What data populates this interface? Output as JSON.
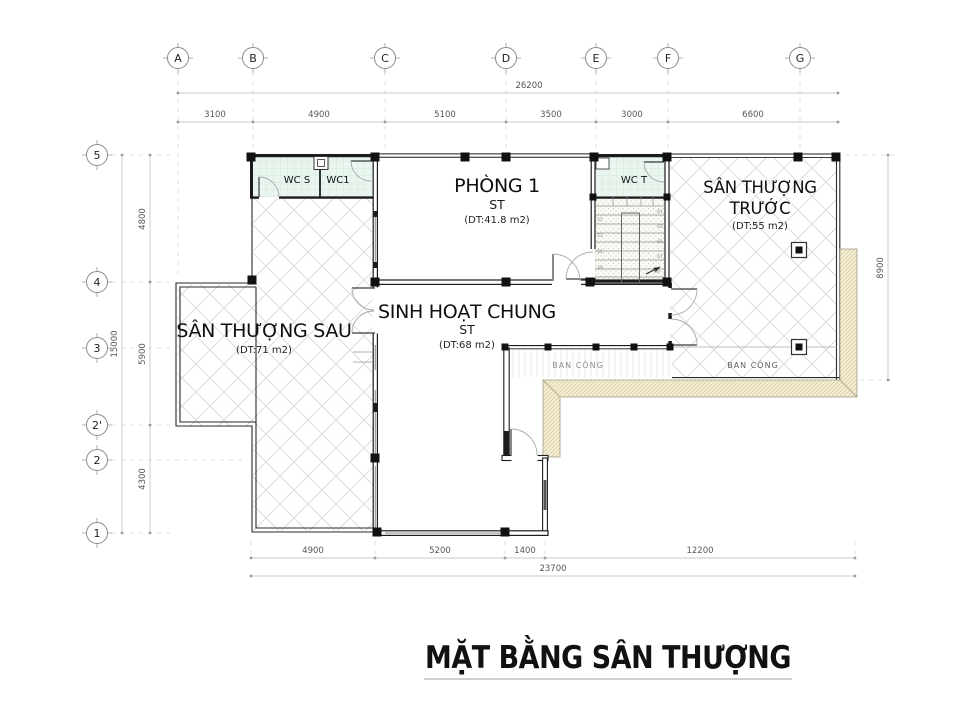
{
  "title": {
    "text": "MẶT BẰNG SÂN THƯỢNG"
  },
  "grid": {
    "cols": [
      "A",
      "B",
      "C",
      "D",
      "E",
      "F",
      "G"
    ],
    "rows": [
      "5",
      "4",
      "3",
      "2'",
      "2",
      "1"
    ]
  },
  "dimensions": {
    "top": {
      "total": "26200",
      "segments": [
        "3100",
        "4900",
        "5100",
        "3500",
        "3000",
        "6600"
      ]
    },
    "bottom": {
      "total": "23700",
      "segments": [
        "4900",
        "5200",
        "1400",
        "12200"
      ]
    },
    "left": {
      "total": "15000",
      "segments": [
        "4800",
        "5900",
        "4300"
      ]
    },
    "right": {
      "total": "8900"
    }
  },
  "rooms": {
    "wc_s": {
      "name": "WC S"
    },
    "wc_1": {
      "name": "WC1"
    },
    "wc_t": {
      "name": "WC T"
    },
    "phong1": {
      "name": "PHÒNG 1",
      "sub": "ST",
      "area": "(DT:41.8 m2)"
    },
    "san_thuong_truoc": {
      "name_line1": "SÂN THƯỢNG",
      "name_line2": "TRƯỚC",
      "area": "(DT:55 m2)"
    },
    "san_thuong_sau": {
      "name": "SÂN THƯỢNG SAU",
      "area": "(DT:71 m2)"
    },
    "sinh_hoat_chung": {
      "name": "SINH HOẠT CHUNG",
      "sub": "ST",
      "area": "(DT:68 m2)"
    },
    "balcony_left": {
      "name": "BAN CÔNG"
    },
    "balcony_right": {
      "name": "BAN CÔNG"
    }
  },
  "stairs": {
    "left_numbers": [
      "55",
      "53",
      "51",
      "49"
    ],
    "right_numbers": [
      "61",
      "63",
      "65",
      "67",
      "69"
    ]
  },
  "colors": {
    "wall": "#1c1c1c",
    "hatch_line": "#dcdcdc",
    "tile_fill": "#e9f5ee",
    "roof_band": "#f2ecd3",
    "dim_text": "#555555"
  }
}
